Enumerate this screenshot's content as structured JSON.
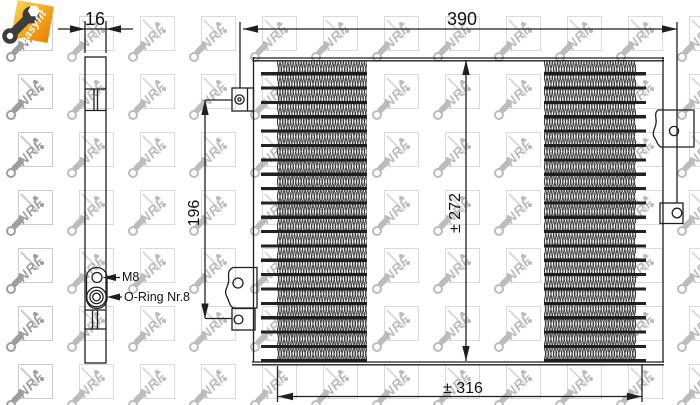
{
  "badge": {
    "label": "easyfit"
  },
  "watermark": {
    "text": "NRF"
  },
  "side_view": {
    "dim_width": "16",
    "fittings": {
      "top": "M8",
      "bottom": "O-Ring Nr.8"
    }
  },
  "front_view": {
    "dim_overall_width": "390",
    "dim_mount_height": "196",
    "dim_core_height": "± 272",
    "dim_bottom_width": "± 316"
  },
  "colors": {
    "line": "#1f1f1f",
    "badge_orange": "#ec7d00",
    "badge_yellow": "#f9d34f",
    "watermark_gray": "#bcbcbc"
  }
}
